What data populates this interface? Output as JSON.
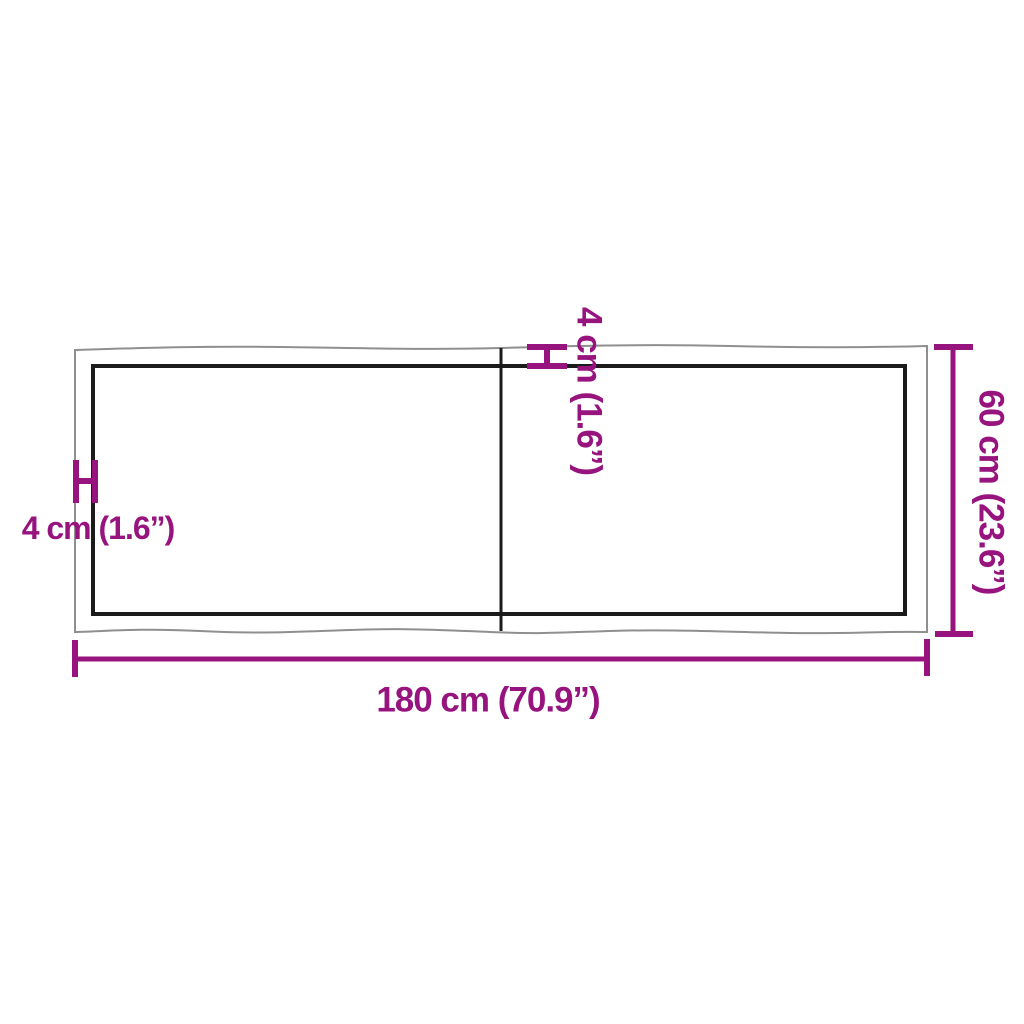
{
  "diagram": {
    "kind": "tabletop-dimension-diagram",
    "view": "top view, two boards with center seam, natural wavy outer edge",
    "labels": {
      "width_bottom": "180 cm (70.9”)",
      "height_right": "60 cm (23.6”)",
      "edge_left": "4 cm (1.6”)",
      "edge_top": "4 cm (1.6”)"
    },
    "colors": {
      "dimension": "#97137E",
      "outline_outer": "#8F8F8F",
      "outline_inner": "#1B1B1B",
      "background": "#FFFFFF"
    }
  }
}
